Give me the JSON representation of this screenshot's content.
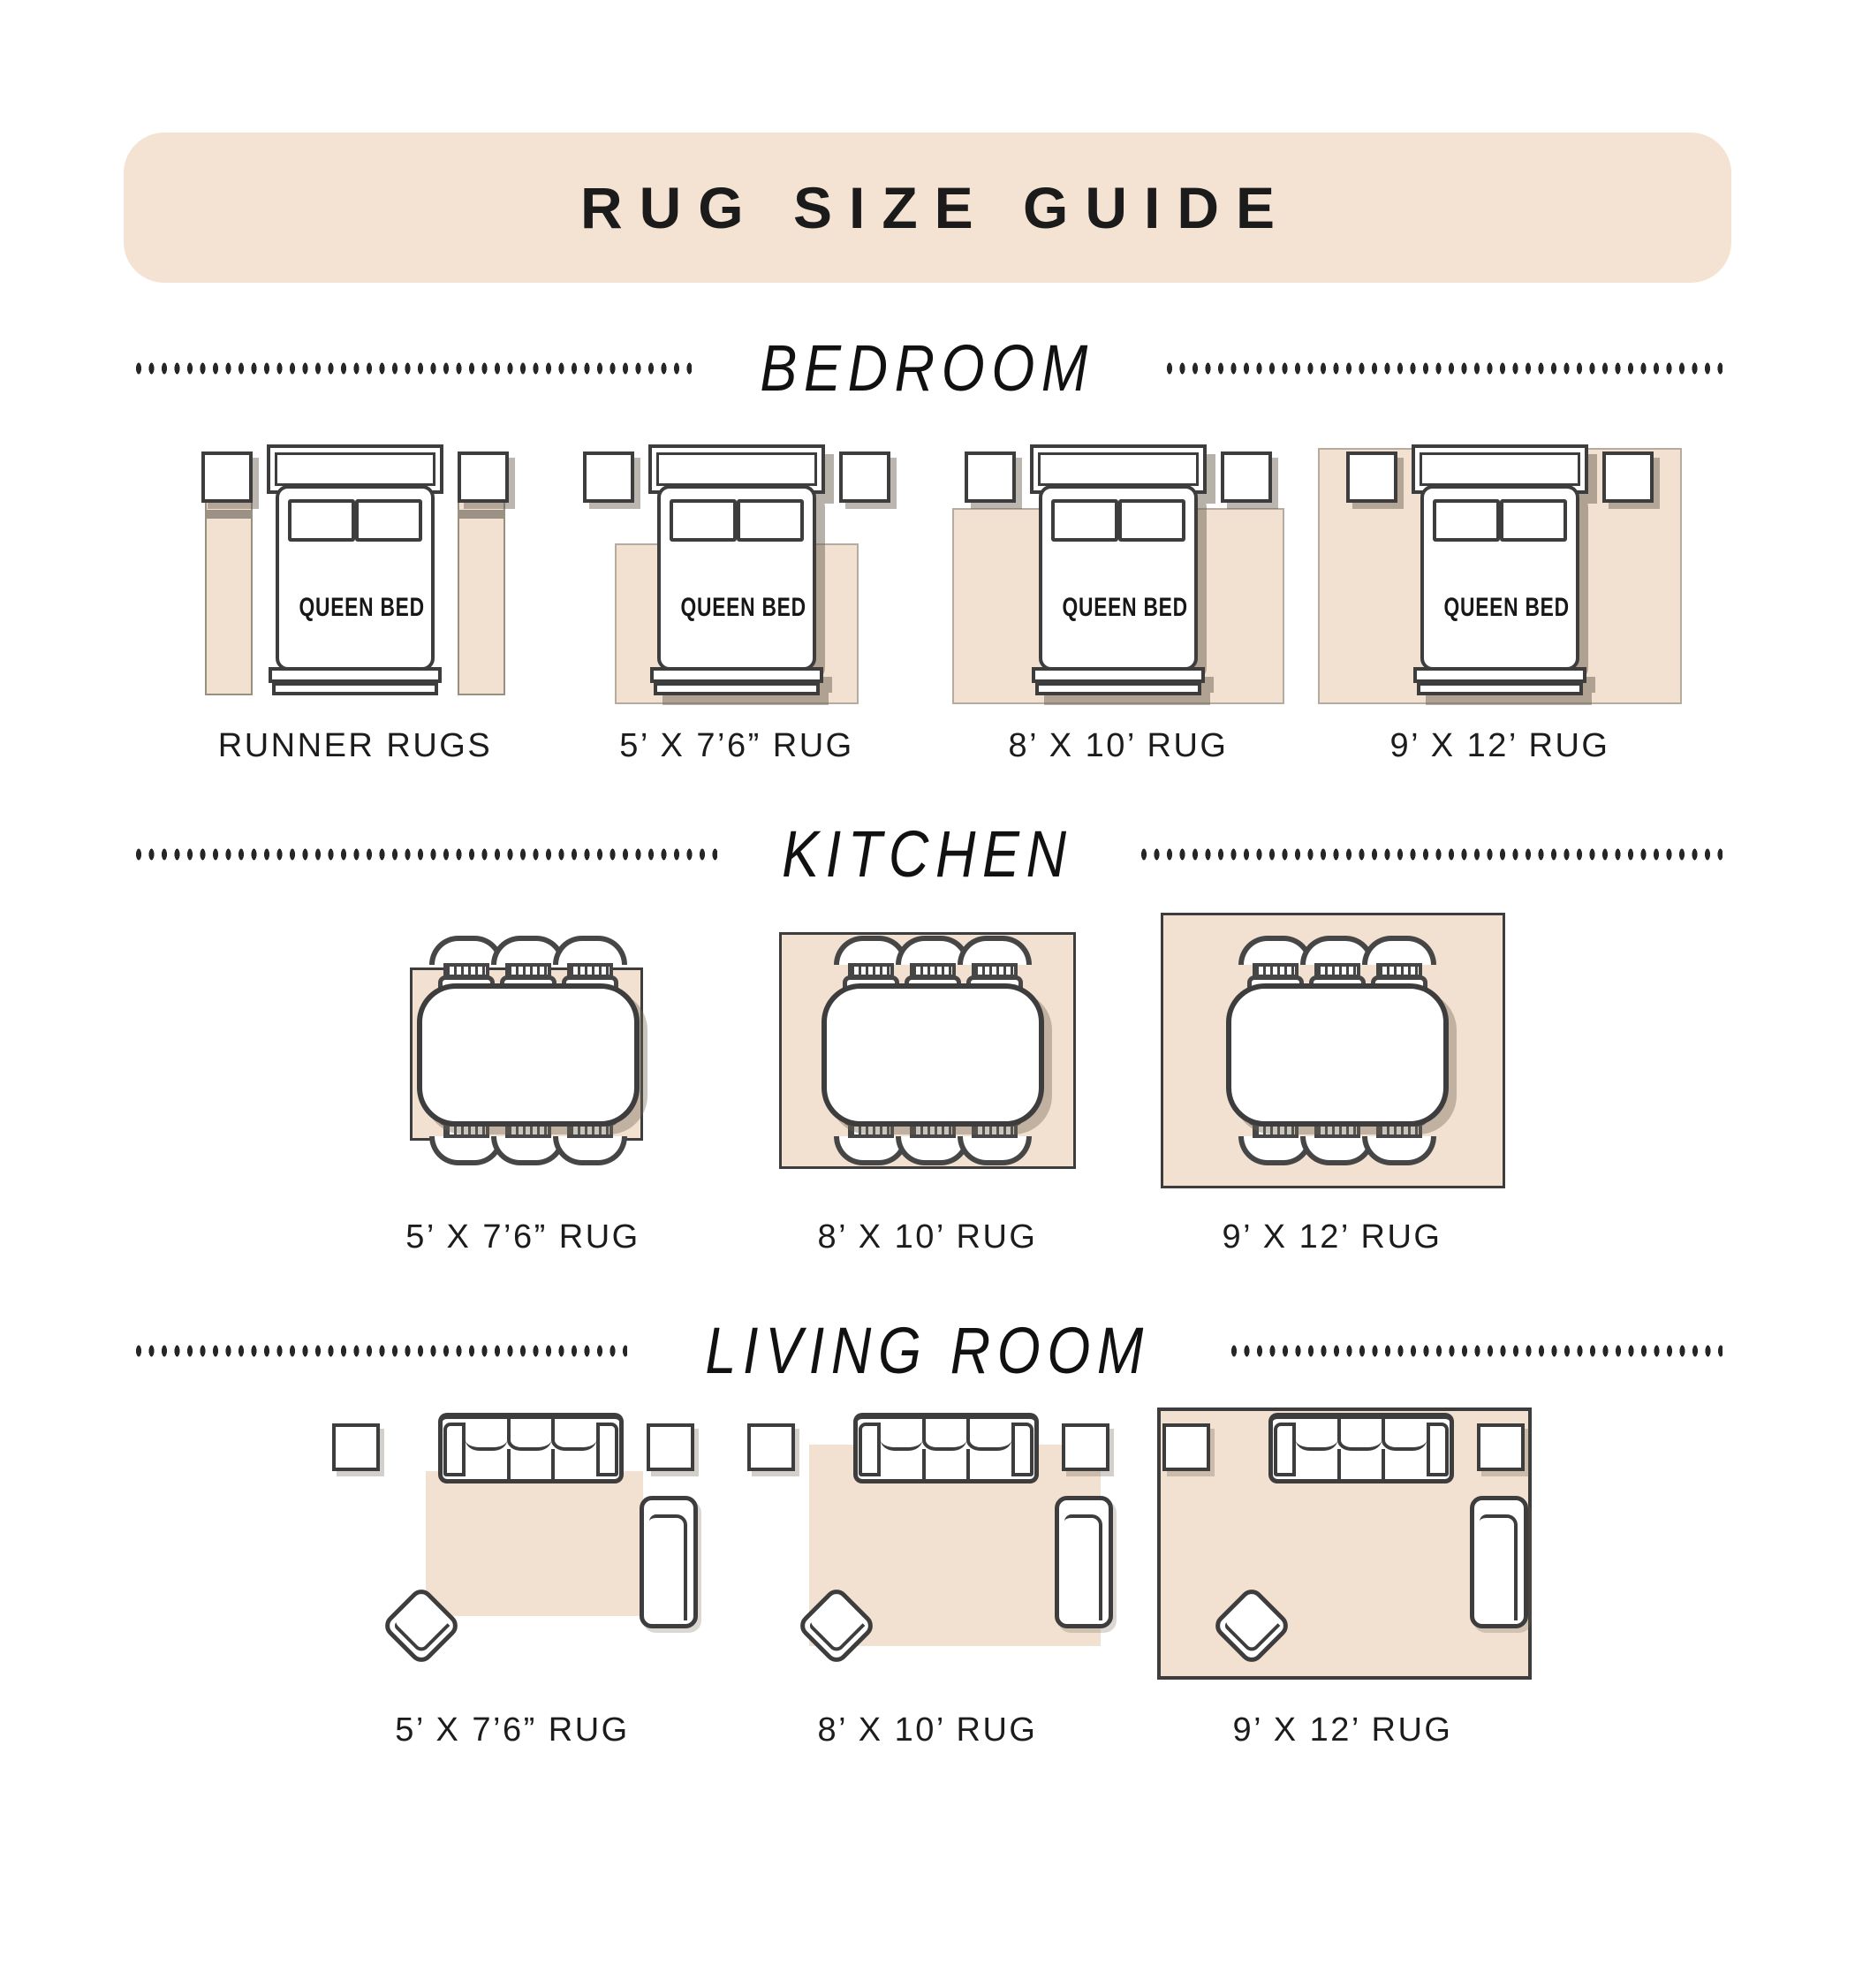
{
  "title": "RUG SIZE GUIDE",
  "bed_label": "QUEEN BED",
  "colors": {
    "banner": "#f4e2d2",
    "rug": "#f2e1d1",
    "line": "#3d3d3d",
    "shadow": "#a59c8f",
    "text": "#1f1f1f"
  },
  "sections": [
    {
      "name": "BEDROOM",
      "items": [
        {
          "label": "RUNNER RUGS"
        },
        {
          "label": "5’ X 7’6” RUG"
        },
        {
          "label": "8’ X 10’ RUG"
        },
        {
          "label": "9’ X 12’ RUG"
        }
      ]
    },
    {
      "name": "KITCHEN",
      "items": [
        {
          "label": "5’ X 7’6” RUG"
        },
        {
          "label": "8’ X 10’ RUG"
        },
        {
          "label": "9’ X 12’ RUG"
        }
      ]
    },
    {
      "name": "LIVING ROOM",
      "items": [
        {
          "label": "5’ X 7’6” RUG"
        },
        {
          "label": "8’ X 10’ RUG"
        },
        {
          "label": "9’ X 12’ RUG"
        }
      ]
    }
  ]
}
